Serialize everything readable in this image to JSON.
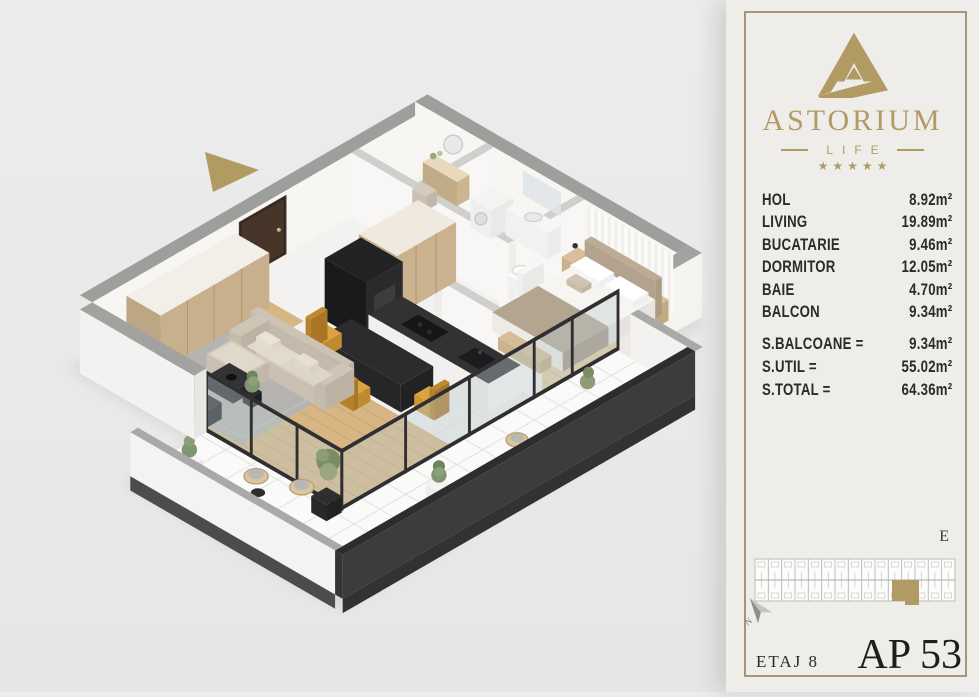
{
  "brand": {
    "name": "ASTORIUM",
    "subtitle": "LIFE",
    "stars": "★★★★★"
  },
  "rooms": [
    {
      "label": "HOL",
      "area": "8.92m²"
    },
    {
      "label": "LIVING",
      "area": "19.89m²"
    },
    {
      "label": "BUCATARIE",
      "area": "9.46m²"
    },
    {
      "label": "DORMITOR",
      "area": "12.05m²"
    },
    {
      "label": "BAIE",
      "area": "4.70m²"
    },
    {
      "label": "BALCON",
      "area": "9.34m²"
    }
  ],
  "totals": [
    {
      "label": "S.BALCOANE =",
      "value": "9.34m²"
    },
    {
      "label": "S.UTIL =",
      "value": "55.02m²"
    },
    {
      "label": "S.TOTAL =",
      "value": "64.36m²"
    }
  ],
  "site": {
    "section_label": "E",
    "compass_letter": "N"
  },
  "footer": {
    "floor_label": "ETAJ 8",
    "apartment_label": "AP 53"
  },
  "colors": {
    "brand_gold": "#b29a63",
    "text_dark": "#2e2d2b",
    "card_bg": "#efedea",
    "card_border": "#a9937a",
    "canvas_bg": "#e9eae9",
    "wall_gray": "#9e9e9c",
    "wood_floor": "#d7b684",
    "balcony_dark": "#3a3a3c",
    "chair_mustard": "#d99c34",
    "highlight_unit": "#b29a63"
  }
}
